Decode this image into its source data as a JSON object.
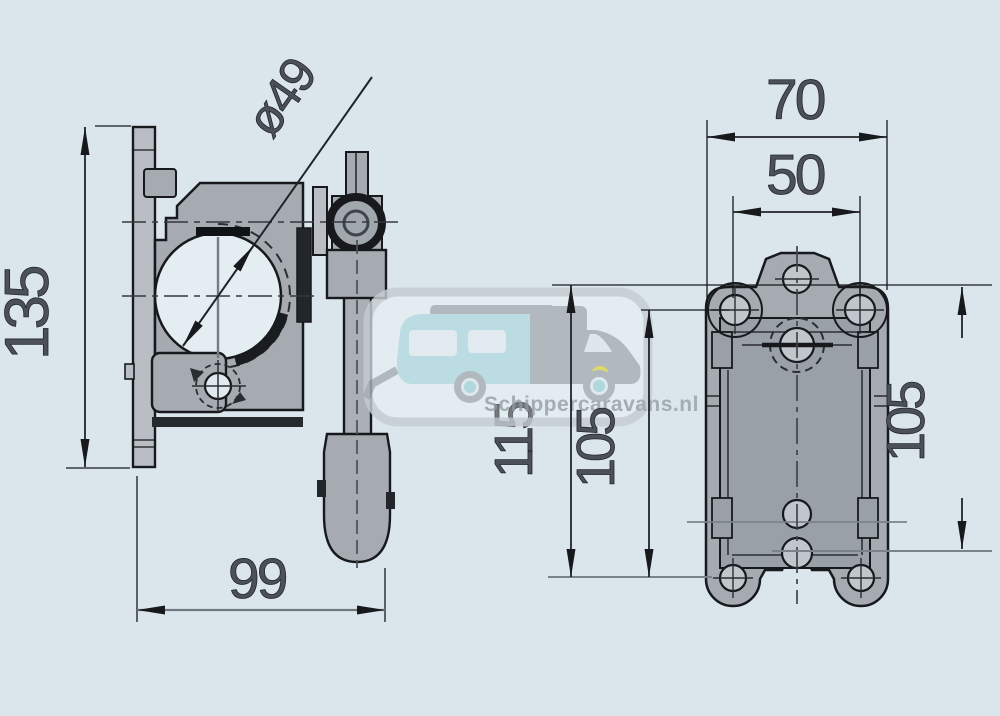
{
  "dimensions": {
    "side_height": "135",
    "clamp_diameter": "ø49",
    "side_width": "99",
    "front_width": "70",
    "front_hole_spacing_h": "50",
    "front_edge_to_holes": "115",
    "front_hole_spacing_v": "105",
    "front_edge_to_center_hole": "105"
  },
  "watermark": {
    "text": "Schippercaravans.nl"
  },
  "colors": {
    "background": "#dbe6ec",
    "part_fill": "#a5abb1",
    "part_light": "#b8bec3",
    "recess_fill": "#99a0a7",
    "bore_fill": "#e3edf2",
    "line_dark": "#17191c",
    "line_gray": "#7b838a",
    "dim_text": "#4b5157",
    "watermark_teal": "#b4dbe1",
    "watermark_gray": "#a9b0b6",
    "watermark_border": "#c6cdd2",
    "watermark_text": "#99a1a8",
    "headlight_yellow": "#ddd64f"
  }
}
